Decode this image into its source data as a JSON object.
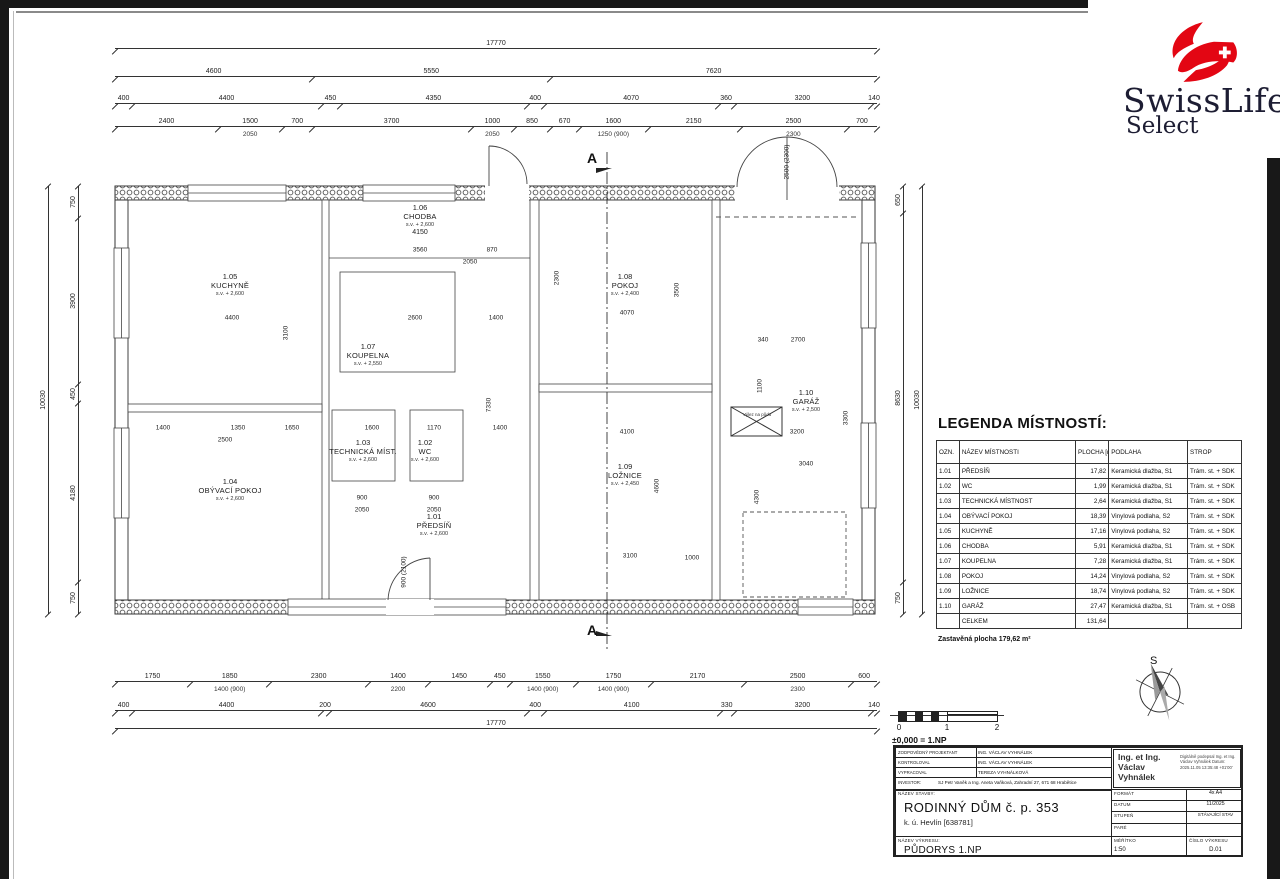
{
  "logo": {
    "brand": "SwissLife",
    "sub": "Select",
    "red": "#e30613",
    "dark": "#1d1d33"
  },
  "plan": {
    "section_label": "A",
    "attic_label": "Výlez na půdu",
    "rooms": [
      {
        "num": "1.05",
        "name": "KUCHYNĚ",
        "sv": "s.v. + 2,600",
        "x": 230,
        "y": 272
      },
      {
        "num": "1.06",
        "name": "CHODBA",
        "sv": "s.v. + 2,600",
        "extra": "4150",
        "x": 420,
        "y": 203
      },
      {
        "num": "1.07",
        "name": "KOUPELNA",
        "sv": "s.v. + 2,550",
        "x": 368,
        "y": 342
      },
      {
        "num": "1.03",
        "name": "TECHNICKÁ MÍST.",
        "sv": "s.v. + 2,600",
        "x": 363,
        "y": 438
      },
      {
        "num": "1.02",
        "name": "WC",
        "sv": "s.v. + 2,600",
        "x": 425,
        "y": 438
      },
      {
        "num": "1.04",
        "name": "OBÝVACÍ POKOJ",
        "sv": "s.v. + 2,600",
        "x": 230,
        "y": 477
      },
      {
        "num": "1.01",
        "name": "PŘEDSÍŇ",
        "sv": "s.v. + 2,600",
        "x": 434,
        "y": 512
      },
      {
        "num": "1.08",
        "name": "POKOJ",
        "sv": "s.v. + 2,400",
        "x": 625,
        "y": 272
      },
      {
        "num": "1.09",
        "name": "LOŽNICE",
        "sv": "s.v. + 2,450",
        "x": 625,
        "y": 462
      },
      {
        "num": "1.10",
        "name": "GARÁŽ",
        "sv": "s.v. + 2,500",
        "x": 806,
        "y": 388
      }
    ],
    "inner_dims": [
      {
        "t": "4400",
        "x": 232,
        "y": 318
      },
      {
        "t": "2600",
        "x": 415,
        "y": 318
      },
      {
        "t": "1400",
        "x": 496,
        "y": 318
      },
      {
        "t": "4070",
        "x": 627,
        "y": 313
      },
      {
        "t": "3560",
        "x": 420,
        "y": 250
      },
      {
        "t": "870",
        "x": 492,
        "y": 250
      },
      {
        "t": "2050",
        "x": 470,
        "y": 262
      },
      {
        "t": "3100",
        "x": 286,
        "y": 333,
        "r": 1
      },
      {
        "t": "3500",
        "x": 677,
        "y": 290,
        "r": 1
      },
      {
        "t": "2300",
        "x": 557,
        "y": 278,
        "r": 1
      },
      {
        "t": "7330",
        "x": 489,
        "y": 405,
        "r": 1
      },
      {
        "t": "2700",
        "x": 798,
        "y": 340
      },
      {
        "t": "340",
        "x": 763,
        "y": 340
      },
      {
        "t": "1100",
        "x": 760,
        "y": 386,
        "r": 1
      },
      {
        "t": "3300",
        "x": 846,
        "y": 418,
        "r": 1
      },
      {
        "t": "1400",
        "x": 163,
        "y": 428
      },
      {
        "t": "1350",
        "x": 238,
        "y": 428
      },
      {
        "t": "1650",
        "x": 292,
        "y": 428
      },
      {
        "t": "2500",
        "x": 225,
        "y": 440
      },
      {
        "t": "1600",
        "x": 372,
        "y": 428
      },
      {
        "t": "1170",
        "x": 434,
        "y": 428
      },
      {
        "t": "1400",
        "x": 500,
        "y": 428
      },
      {
        "t": "900",
        "x": 362,
        "y": 498
      },
      {
        "t": "900",
        "x": 434,
        "y": 498
      },
      {
        "t": "2050",
        "x": 362,
        "y": 510
      },
      {
        "t": "2050",
        "x": 434,
        "y": 510
      },
      {
        "t": "4100",
        "x": 627,
        "y": 432
      },
      {
        "t": "4600",
        "x": 657,
        "y": 486,
        "r": 1
      },
      {
        "t": "3100",
        "x": 630,
        "y": 556
      },
      {
        "t": "1000",
        "x": 692,
        "y": 558
      },
      {
        "t": "3040",
        "x": 806,
        "y": 464
      },
      {
        "t": "4300",
        "x": 757,
        "y": 497,
        "r": 1
      },
      {
        "t": "3200",
        "x": 797,
        "y": 432
      },
      {
        "t": "2500 (2300)",
        "x": 787,
        "y": 162,
        "r": 1
      },
      {
        "t": "900 (2100)",
        "x": 404,
        "y": 572,
        "r": 1
      }
    ]
  },
  "dims": {
    "top_rows": [
      {
        "id": "t1",
        "cells": [
          [
            17770,
            "17770"
          ]
        ]
      },
      {
        "id": "t2",
        "cells": [
          [
            4600,
            "4600"
          ],
          [
            5550,
            "5550"
          ],
          [
            7620,
            "7620"
          ]
        ]
      },
      {
        "id": "t3",
        "cells": [
          [
            400,
            "400"
          ],
          [
            4400,
            "4400"
          ],
          [
            450,
            "450"
          ],
          [
            4350,
            "4350"
          ],
          [
            400,
            "400"
          ],
          [
            4070,
            "4070"
          ],
          [
            360,
            "360"
          ],
          [
            3200,
            "3200"
          ],
          [
            140,
            "140"
          ]
        ]
      },
      {
        "id": "t4",
        "cells": [
          [
            2400,
            "2400"
          ],
          [
            1500,
            "1500"
          ],
          [
            700,
            "700"
          ],
          [
            3700,
            "3700"
          ],
          [
            1000,
            "1000"
          ],
          [
            850,
            "850"
          ],
          [
            670,
            "670"
          ],
          [
            1600,
            "1600"
          ],
          [
            2150,
            "2150"
          ],
          [
            2500,
            "2500"
          ],
          [
            700,
            "700"
          ]
        ]
      },
      {
        "id": "t5",
        "sub": true,
        "cells": [
          [
            2400,
            ""
          ],
          [
            1500,
            "2050"
          ],
          [
            700,
            ""
          ],
          [
            3700,
            ""
          ],
          [
            1000,
            "2050"
          ],
          [
            850,
            ""
          ],
          [
            670,
            ""
          ],
          [
            1600,
            "1250 (900)"
          ],
          [
            2150,
            ""
          ],
          [
            2500,
            "2300"
          ],
          [
            700,
            ""
          ]
        ]
      }
    ],
    "bottom_rows": [
      {
        "id": "b1",
        "cells": [
          [
            1750,
            "1750"
          ],
          [
            1850,
            "1850"
          ],
          [
            2300,
            "2300"
          ],
          [
            1400,
            "1400"
          ],
          [
            1450,
            "1450"
          ],
          [
            450,
            "450"
          ],
          [
            1550,
            "1550"
          ],
          [
            1750,
            "1750"
          ],
          [
            2170,
            "2170"
          ],
          [
            2500,
            "2500"
          ],
          [
            600,
            "600"
          ]
        ]
      },
      {
        "id": "b2",
        "sub": true,
        "cells": [
          [
            1750,
            ""
          ],
          [
            1850,
            "1400 (900)"
          ],
          [
            2300,
            ""
          ],
          [
            1400,
            "2200"
          ],
          [
            1450,
            ""
          ],
          [
            450,
            ""
          ],
          [
            1550,
            "1400 (900)"
          ],
          [
            1750,
            "1400 (900)"
          ],
          [
            2170,
            ""
          ],
          [
            2500,
            "2300"
          ],
          [
            600,
            ""
          ]
        ]
      },
      {
        "id": "b3",
        "cells": [
          [
            400,
            "400"
          ],
          [
            4400,
            "4400"
          ],
          [
            200,
            "200"
          ],
          [
            4600,
            "4600"
          ],
          [
            400,
            "400"
          ],
          [
            4100,
            "4100"
          ],
          [
            330,
            "330"
          ],
          [
            3200,
            "3200"
          ],
          [
            140,
            "140"
          ]
        ]
      },
      {
        "id": "b4",
        "cells": [
          [
            17770,
            "17770"
          ]
        ]
      }
    ],
    "left_cols": [
      {
        "id": "l1",
        "cells": [
          [
            10030,
            "10030"
          ]
        ]
      },
      {
        "id": "l2",
        "cells": [
          [
            750,
            "750"
          ],
          [
            3900,
            "3900"
          ],
          [
            450,
            "450"
          ],
          [
            4180,
            "4180"
          ],
          [
            750,
            "750"
          ]
        ]
      }
    ],
    "right_cols": [
      {
        "id": "r1",
        "cells": [
          [
            650,
            "650"
          ],
          [
            8630,
            "8630"
          ],
          [
            750,
            "750"
          ]
        ]
      },
      {
        "id": "r2",
        "cells": [
          [
            10030,
            "10030"
          ]
        ]
      }
    ]
  },
  "legend": {
    "title": "LEGENDA MÍSTNOSTÍ:",
    "headers": [
      "OZN.",
      "NÁZEV MÍSTNOSTI",
      "PLOCHA [m²]",
      "PODLAHA",
      "STROP"
    ],
    "rows": [
      [
        "1.01",
        "PŘEDSÍŇ",
        "17,82",
        "Keramická dlažba, S1",
        "Trám. st. + SDK"
      ],
      [
        "1.02",
        "WC",
        "1,99",
        "Keramická dlažba, S1",
        "Trám. st. + SDK"
      ],
      [
        "1.03",
        "TECHNICKÁ MÍSTNOST",
        "2,64",
        "Keramická dlažba, S1",
        "Trám. st. + SDK"
      ],
      [
        "1.04",
        "OBÝVACÍ POKOJ",
        "18,39",
        "Vinylová podlaha, S2",
        "Trám. st. + SDK"
      ],
      [
        "1.05",
        "KUCHYNĚ",
        "17,16",
        "Vinylová podlaha, S2",
        "Trám. st. + SDK"
      ],
      [
        "1.06",
        "CHODBA",
        "5,91",
        "Keramická dlažba, S1",
        "Trám. st. + SDK"
      ],
      [
        "1.07",
        "KOUPELNA",
        "7,28",
        "Keramická dlažba, S1",
        "Trám. st. + SDK"
      ],
      [
        "1.08",
        "POKOJ",
        "14,24",
        "Vinylová podlaha, S2",
        "Trám. st. + SDK"
      ],
      [
        "1.09",
        "LOŽNICE",
        "18,74",
        "Vinylová podlaha, S2",
        "Trám. st. + SDK"
      ],
      [
        "1.10",
        "GARÁŽ",
        "27,47",
        "Keramická dlažba, S1",
        "Trám. st. + OSB"
      ],
      [
        "",
        "CELKEM",
        "131,64",
        "",
        ""
      ]
    ],
    "footnote": "Zastavěná plocha 179,62 m²"
  },
  "scalebar": {
    "ticks": [
      "0",
      "1",
      "2"
    ],
    "note": "±0,000 = 1.NP"
  },
  "compass": {
    "north": "S"
  },
  "titleblock": {
    "rows": [
      [
        "ZODPOVĚDNÝ PROJEKTANT",
        "ING. VÁCLAV VYHNÁLEK"
      ],
      [
        "KONTROLOVAL",
        "ING. VÁCLAV VYHNÁLEK"
      ],
      [
        "VYPRACOVAL",
        "TEREZA VYHNÁLKOVÁ"
      ],
      [
        "INVESTOR:",
        "SJ Petr Vaněk a Ing. Aneta Vaňková, Zahradní 27, 671 68 Hrabětice"
      ]
    ],
    "signature": {
      "name": "Ing. et Ing. Václav Vyhnálek",
      "note": "Digitálně podepsal Ing. et Ing. Václav Vyhnálek Datum: 2025.11.05 13:35:48 +01'00'"
    },
    "nazev_stavby_label": "NÁZEV STAVBY:",
    "nazev_stavby": "RODINNÝ DŮM č. p. 353",
    "ku": "k. ú. Hevlín [638781]",
    "format_label": "FORMÁT",
    "format": "4x A4",
    "datum_label": "DATUM",
    "datum": "11/2025",
    "stupen_label": "STUPEŇ",
    "stupen": "STÁVAJÍCÍ STAV",
    "pare_label": "PARÉ",
    "pare": "",
    "nazev_vykresu_label": "NÁZEV VÝKRESU:",
    "nazev_vykresu": "PŮDORYS 1.NP",
    "meritko_label": "MĚŘÍTKO",
    "meritko": "1:50",
    "cislo_label": "ČÍSLO VÝKRESU",
    "cislo": "D.01"
  }
}
